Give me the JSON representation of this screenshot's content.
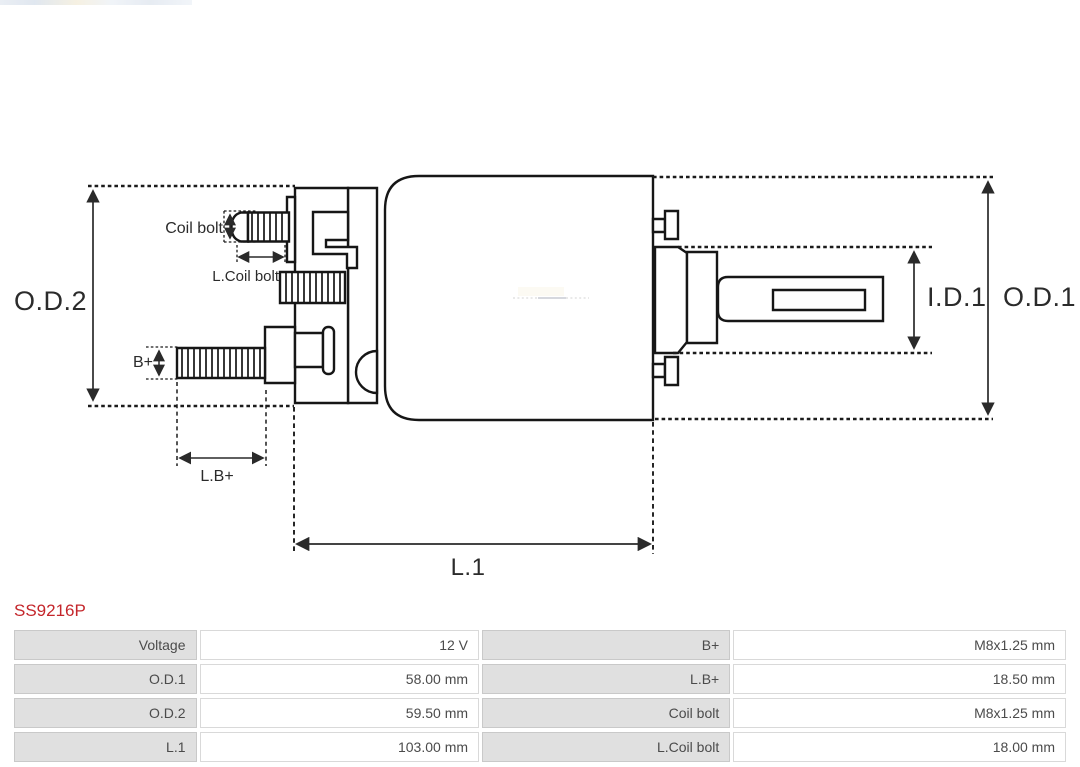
{
  "page": {
    "background": "#ffffff"
  },
  "part": {
    "number": "SS9216P",
    "number_color": "#c4262b"
  },
  "diagram": {
    "type": "technical-drawing-solenoid-side-view",
    "line_color": "#161616",
    "dimension_color": "#2a2a2a",
    "labels": {
      "od2": "O.D.2",
      "od1": "O.D.1",
      "id1": "I.D.1",
      "l1": "L.1",
      "b_plus": "B+",
      "l_b_plus": "L.B+",
      "coil_bolt": "Coil bolt",
      "l_coil_bolt": "L.Coil bolt"
    }
  },
  "spec_table": {
    "label_bg": "#e0e0e0",
    "text_color": "#4b4b4b",
    "rows": [
      [
        "Voltage",
        "12 V",
        "B+",
        "M8x1.25 mm"
      ],
      [
        "O.D.1",
        "58.00 mm",
        "L.B+",
        "18.50 mm"
      ],
      [
        "O.D.2",
        "59.50 mm",
        "Coil bolt",
        "M8x1.25 mm"
      ],
      [
        "L.1",
        "103.00 mm",
        "L.Coil bolt",
        "18.00 mm"
      ]
    ]
  }
}
